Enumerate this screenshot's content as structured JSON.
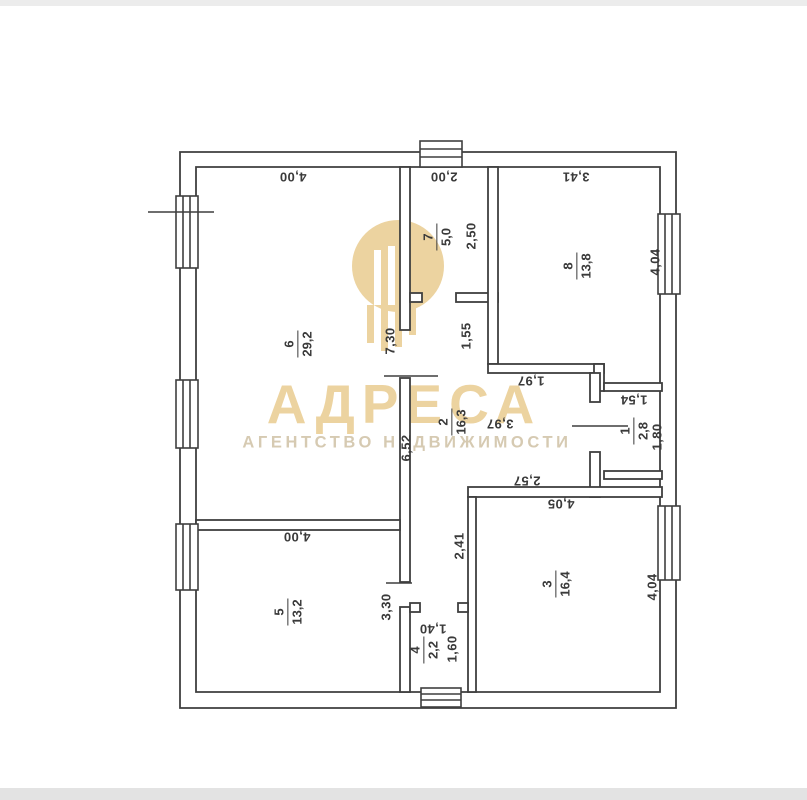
{
  "watermark": {
    "brand": "АДРЕСА",
    "tagline": "АГЕНТСТВО НЕДВИЖИМОСТИ",
    "brand_color": "#ecd3a0",
    "tagline_color": "#d6cab2",
    "logo": "building-columns"
  },
  "plan": {
    "line_color": "#3f3f3f",
    "rooms": [
      {
        "number": "6",
        "area": "29,2",
        "x": 298,
        "y": 344
      },
      {
        "number": "7",
        "area": "5,0",
        "x": 437,
        "y": 237
      },
      {
        "number": "8",
        "area": "13,8",
        "x": 577,
        "y": 266
      },
      {
        "number": "2",
        "area": "16,3",
        "x": 452,
        "y": 422
      },
      {
        "number": "1",
        "area": "2,8",
        "x": 634,
        "y": 431
      },
      {
        "number": "3",
        "area": "16,4",
        "x": 556,
        "y": 584
      },
      {
        "number": "5",
        "area": "13,2",
        "x": 288,
        "y": 612
      },
      {
        "number": "4",
        "area": "2,2",
        "x": 424,
        "y": 650
      }
    ],
    "dimensions": [
      {
        "t": "4,00",
        "x": 293,
        "y": 177,
        "o": "f"
      },
      {
        "t": "2,00",
        "x": 444,
        "y": 177,
        "o": "f"
      },
      {
        "t": "3,41",
        "x": 576,
        "y": 177,
        "o": "f"
      },
      {
        "t": "2,50",
        "x": 471,
        "y": 236,
        "o": "v"
      },
      {
        "t": "4,04",
        "x": 655,
        "y": 262,
        "o": "v"
      },
      {
        "t": "1,55",
        "x": 466,
        "y": 336,
        "o": "v"
      },
      {
        "t": "7,30",
        "x": 390,
        "y": 341,
        "o": "v"
      },
      {
        "t": "1,97",
        "x": 531,
        "y": 381,
        "o": "f"
      },
      {
        "t": "1,54",
        "x": 634,
        "y": 400,
        "o": "f"
      },
      {
        "t": "3,97",
        "x": 500,
        "y": 424,
        "o": "f"
      },
      {
        "t": "6,52",
        "x": 406,
        "y": 448,
        "o": "v"
      },
      {
        "t": "1,80",
        "x": 657,
        "y": 437,
        "o": "v"
      },
      {
        "t": "2,57",
        "x": 527,
        "y": 481,
        "o": "f"
      },
      {
        "t": "4,05",
        "x": 561,
        "y": 504,
        "o": "f"
      },
      {
        "t": "4,00",
        "x": 297,
        "y": 537,
        "o": "f"
      },
      {
        "t": "2,41",
        "x": 459,
        "y": 546,
        "o": "v"
      },
      {
        "t": "3,30",
        "x": 386,
        "y": 607,
        "o": "v"
      },
      {
        "t": "4,04",
        "x": 652,
        "y": 587,
        "o": "v"
      },
      {
        "t": "1,40",
        "x": 433,
        "y": 629,
        "o": "f"
      },
      {
        "t": "1,60",
        "x": 452,
        "y": 649,
        "o": "v"
      }
    ]
  }
}
